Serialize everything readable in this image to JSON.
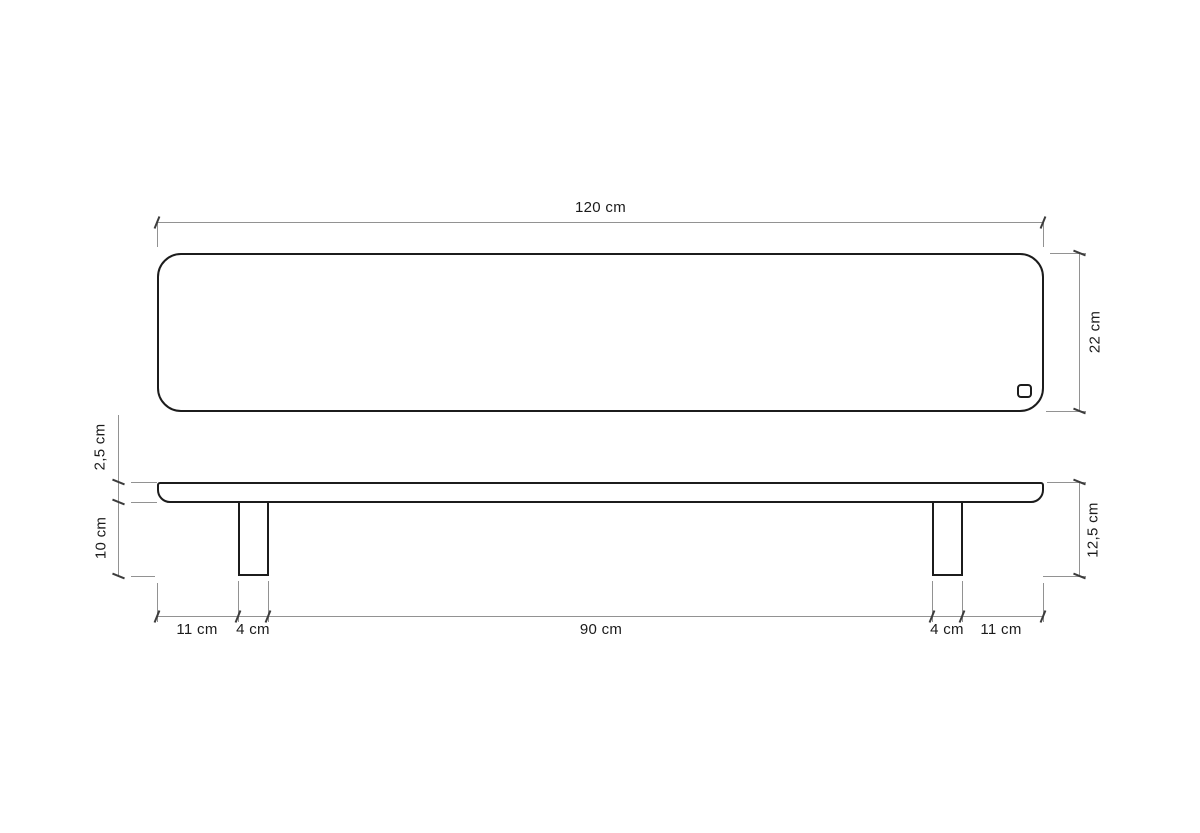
{
  "drawing": {
    "type": "technical-drawing",
    "labels": {
      "overall_width": "120 cm",
      "overall_depth": "22 cm",
      "top_thickness": "2,5 cm",
      "leg_height": "10 cm",
      "overall_height": "12,5 cm",
      "bottom_left_overhang": "11 cm",
      "bottom_left_leg": "4 cm",
      "bottom_span": "90 cm",
      "bottom_right_leg": "4 cm",
      "bottom_right_overhang": "11 cm"
    },
    "colors": {
      "outline": "#1c1c1c",
      "dimension_line": "#929292",
      "tick": "#3c3c3c",
      "label_text": "#1b1b1b",
      "background": "#ffffff"
    }
  }
}
